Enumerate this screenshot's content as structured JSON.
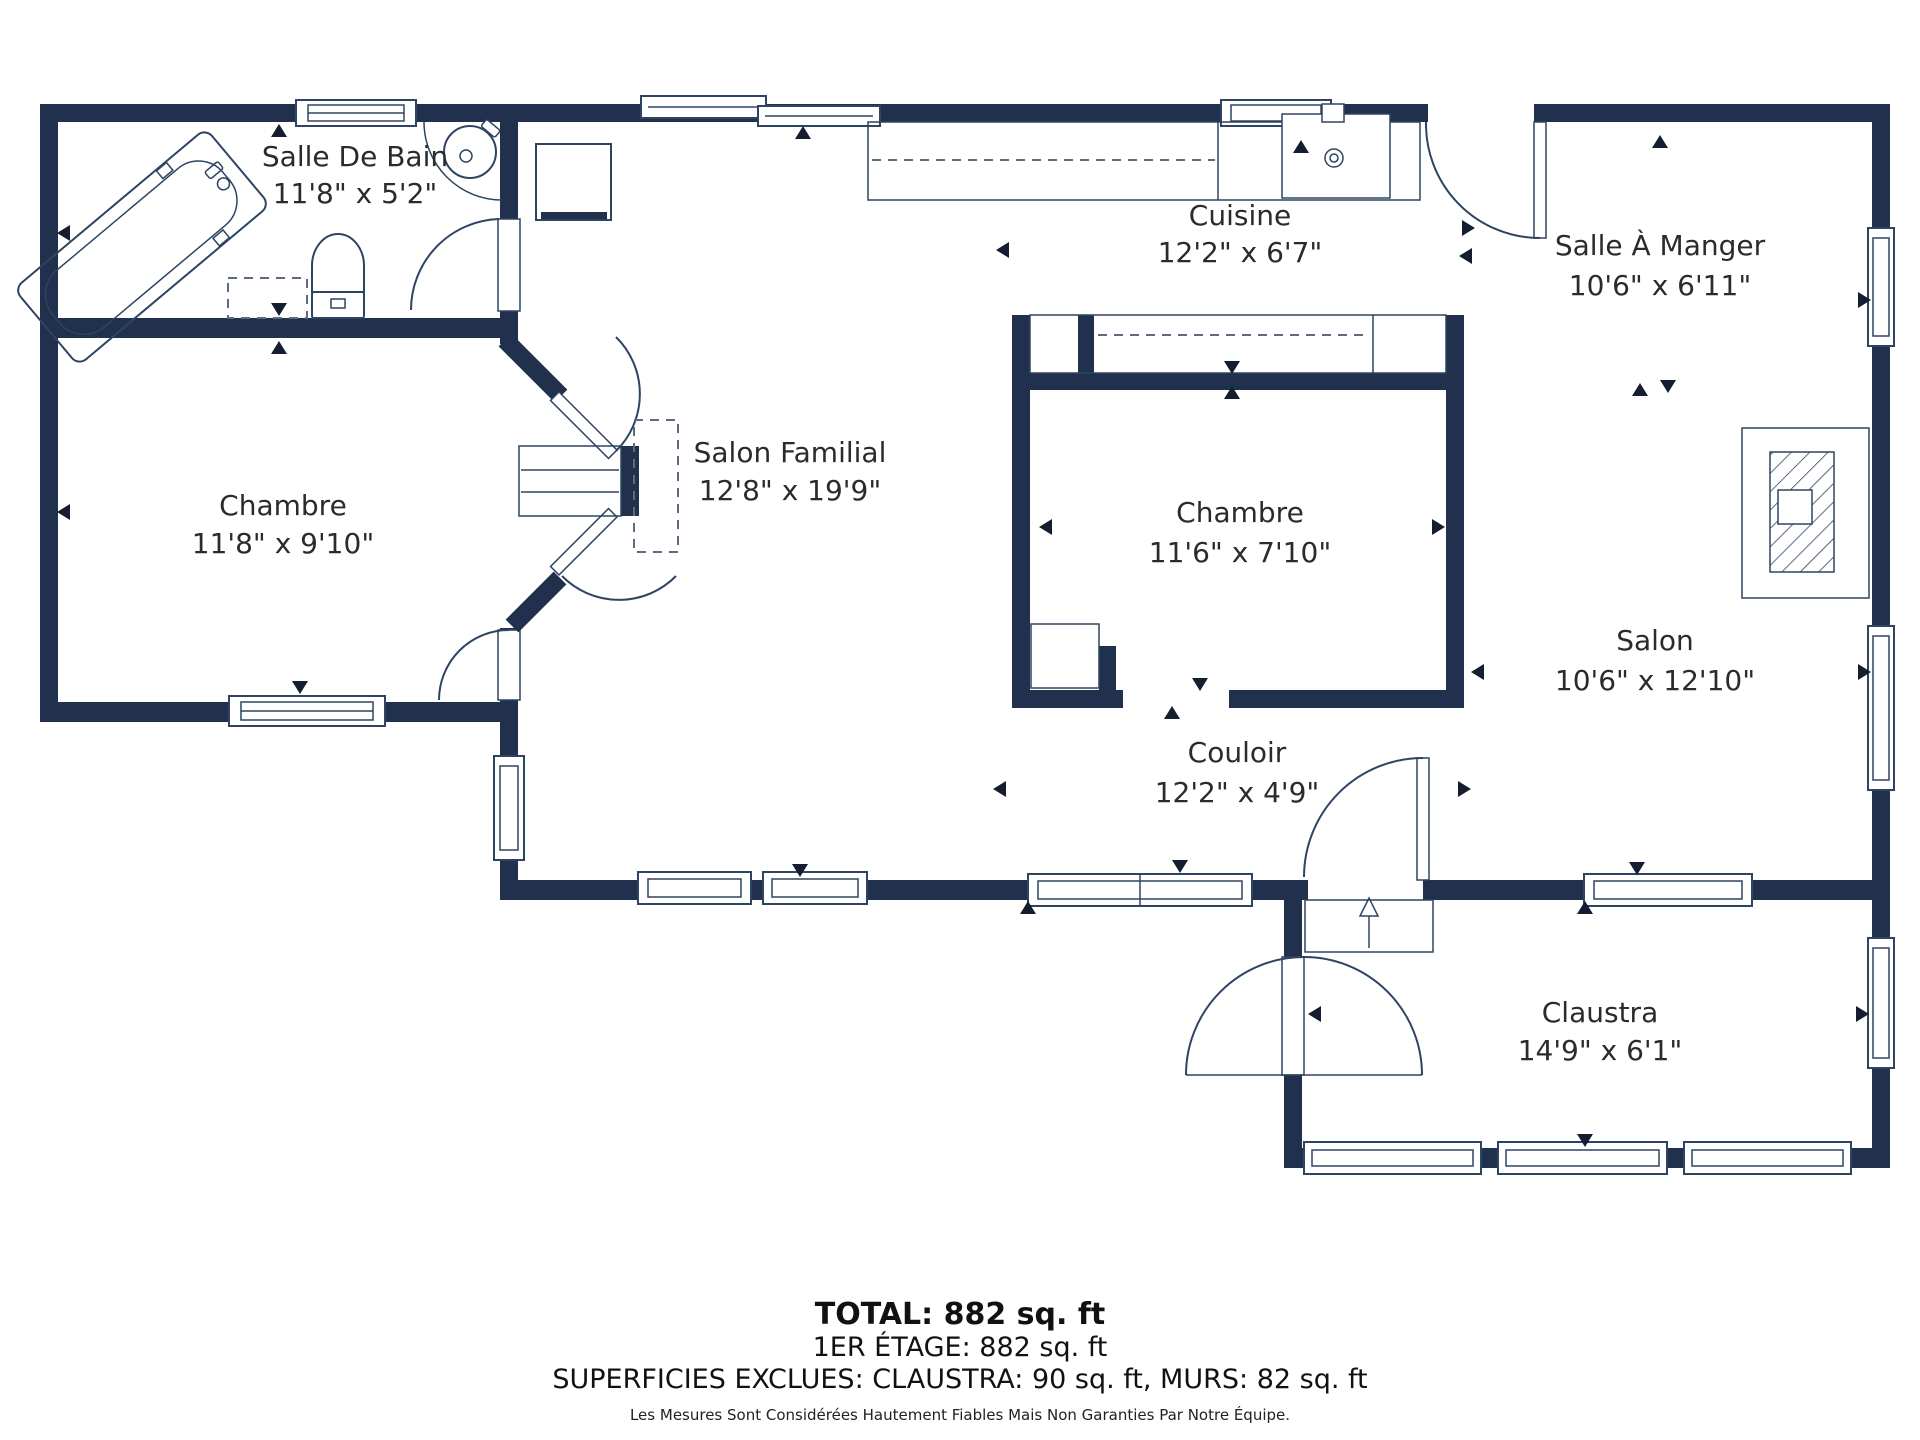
{
  "plan": {
    "title": "Plan du 1er étage",
    "colors": {
      "wall": "#21304c",
      "fixture_line": "#2d4462",
      "label_text": "#2b2b2b",
      "marker": "#141e30"
    },
    "rooms": [
      {
        "id": "salle-de-bain",
        "name": "Salle De Bain",
        "dimensions": "11'8\" x 5'2\""
      },
      {
        "id": "chambre-ouest",
        "name": "Chambre",
        "dimensions": "11'8\" x 9'10\""
      },
      {
        "id": "salon-familial",
        "name": "Salon Familial",
        "dimensions": "12'8\" x 19'9\""
      },
      {
        "id": "cuisine",
        "name": "Cuisine",
        "dimensions": "12'2\" x 6'7\""
      },
      {
        "id": "salle-a-manger",
        "name": "Salle À Manger",
        "dimensions": "10'6\" x 6'11\""
      },
      {
        "id": "chambre-centre",
        "name": "Chambre",
        "dimensions": "11'6\" x 7'10\""
      },
      {
        "id": "salon",
        "name": "Salon",
        "dimensions": "10'6\" x 12'10\""
      },
      {
        "id": "couloir",
        "name": "Couloir",
        "dimensions": "12'2\" x 4'9\""
      },
      {
        "id": "claustra",
        "name": "Claustra",
        "dimensions": "14'9\" x 6'1\""
      }
    ]
  },
  "summary": {
    "total": "TOTAL: 882 sq. ft",
    "floor": "1ER ÉTAGE: 882 sq. ft",
    "excluded": "SUPERFICIES EXCLUES: CLAUSTRA: 90 sq. ft, MURS: 82 sq. ft",
    "disclaimer": "Les Mesures Sont Considérées Hautement Fiables Mais Non Garanties Par Notre Équipe."
  }
}
